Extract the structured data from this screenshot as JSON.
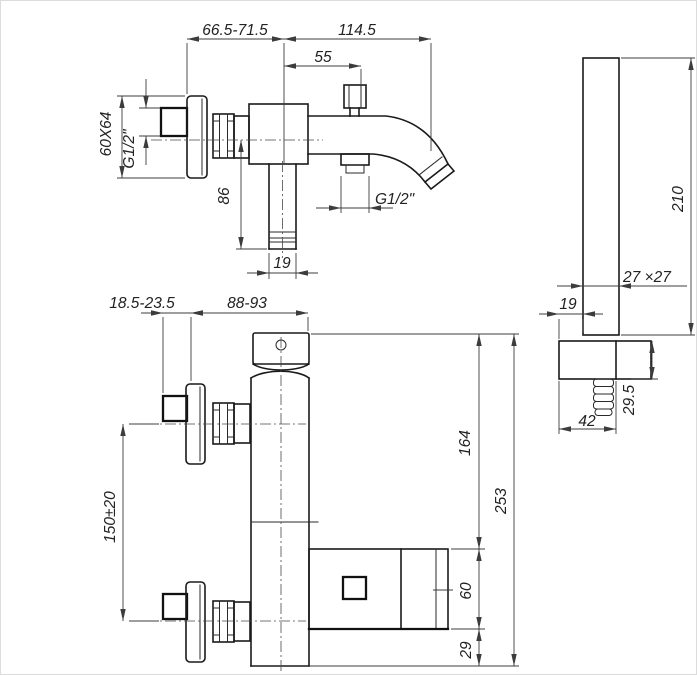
{
  "drawing": {
    "colors": {
      "background": "#ffffff",
      "object_line": "#1a1a1a",
      "dimension_line": "#3c3c3c"
    },
    "top_view": {
      "wall_projection_range": "66.5-71.5",
      "spout_reach": "114.5",
      "diverter_offset": "55",
      "escutcheon_size": "60X64",
      "inlet_thread": "G1/2\"",
      "drop_height": "86",
      "pipe_width": "19",
      "shower_outlet_thread": "G1/2\""
    },
    "front_view": {
      "wall_adjust_range": "18.5-23.5",
      "body_projection_range": "88-93",
      "inlet_spacing": "150±20",
      "upper_height": "164",
      "block_height": "60",
      "foot_height": "29",
      "total_height": "253"
    },
    "side_view": {
      "handshower_length": "210",
      "handle_section": "27 ×27",
      "head_offset": "19",
      "bracket_height": "29.5",
      "head_depth": "42"
    }
  }
}
